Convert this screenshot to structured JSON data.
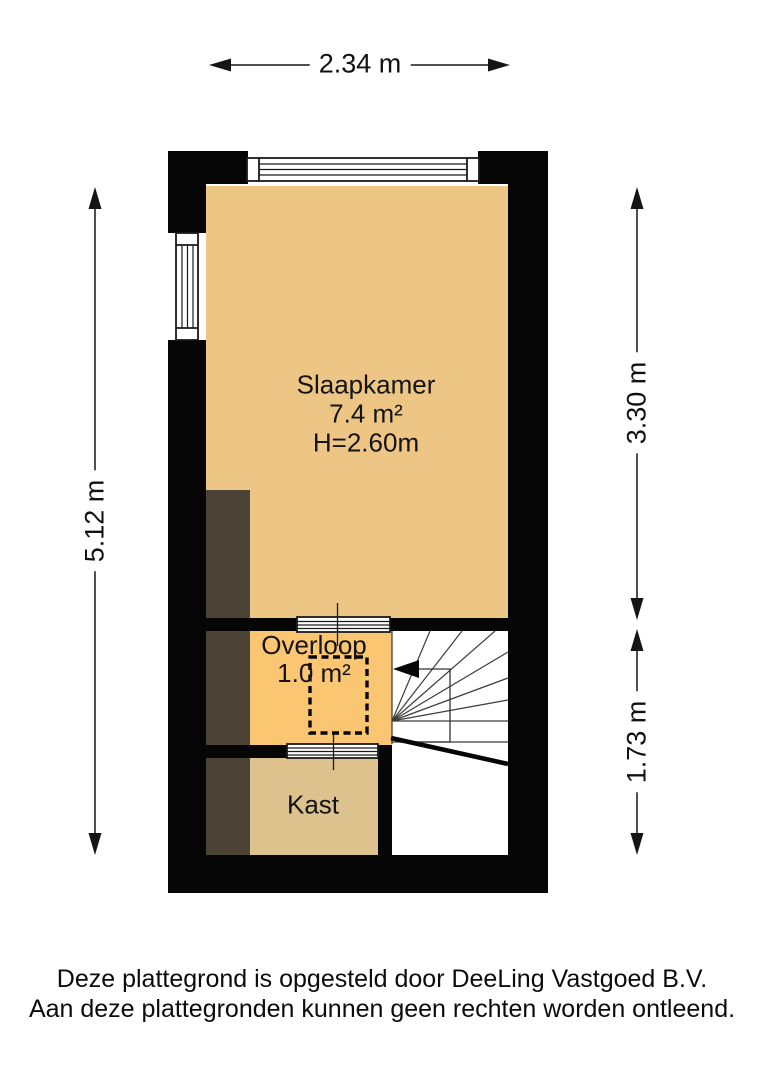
{
  "plan": {
    "type": "floorplan",
    "rooms": [
      {
        "id": "slaapkamer",
        "name": "Slaapkamer",
        "area": "7.4 m²",
        "ceiling_height": "H=2.60m"
      },
      {
        "id": "overloop",
        "name": "Overloop",
        "area": "1.0 m²"
      },
      {
        "id": "kast",
        "name": "Kast"
      }
    ],
    "dimensions": {
      "top_width": "2.34 m",
      "left_height": "5.12 m",
      "right_upper": "3.30 m",
      "right_lower": "1.73 m"
    },
    "colors": {
      "bedroom_floor": "#edc585",
      "landing_floor": "#fbc672",
      "closet_floor": "#dec28e",
      "dark_zone": "#4a4336",
      "wall": "#060606",
      "background": "#ffffff"
    },
    "features": [
      "window-top",
      "window-left",
      "winder-staircase",
      "stairs-direction-arrow",
      "loft-hatch-dashed-outline",
      "door-bedroom-landing",
      "door-landing-closet"
    ]
  },
  "footer": {
    "line1": "Deze plattegrond is opgesteld door DeeLing Vastgoed B.V.",
    "line2": "Aan deze plattegronden kunnen geen rechten worden ontleend."
  }
}
